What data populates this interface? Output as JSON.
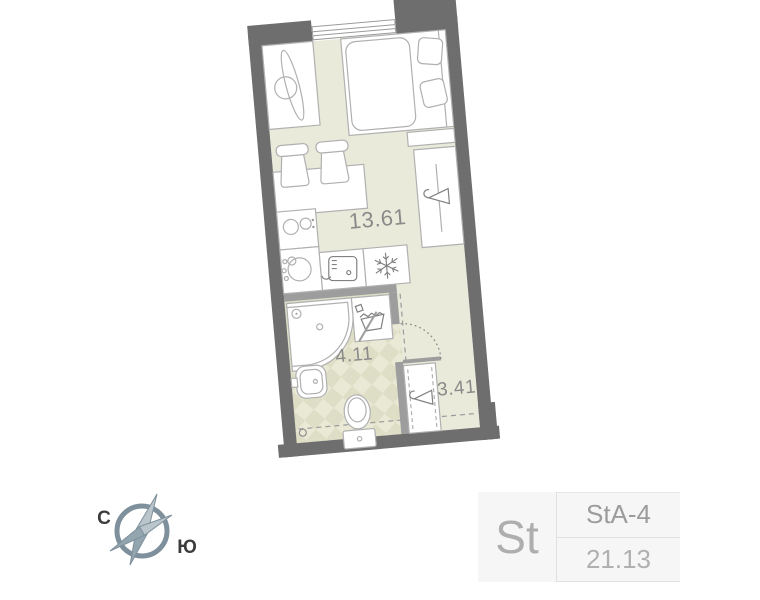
{
  "floor_plan": {
    "rooms": [
      {
        "name": "living-kitchen",
        "area": "13.61"
      },
      {
        "name": "bathroom",
        "area": "4.11"
      },
      {
        "name": "hallway",
        "area": "3.41"
      }
    ],
    "compass": {
      "north": "С",
      "south": "Ю"
    },
    "colors": {
      "outer_wall": "#6e6e6e",
      "partition": "#9d9d9d",
      "floor": "#eaeadb",
      "bath_tile": "#dedec6",
      "furniture_stroke": "#b0b0b0",
      "label_text": "#8a8a8a",
      "compass": "#7e909b",
      "card_bg": "#f6f6f6"
    }
  },
  "info_card": {
    "plan_type": "St",
    "plan_code": "StA-4",
    "total_area": "21.13"
  }
}
